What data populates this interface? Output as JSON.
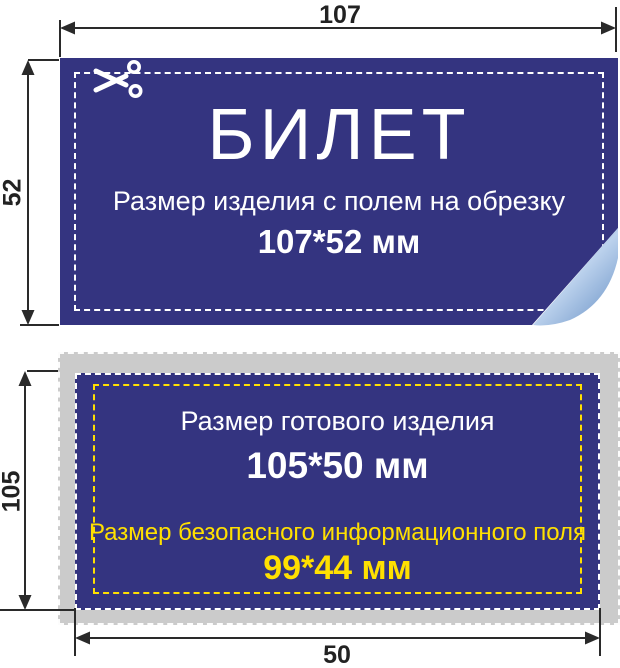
{
  "colors": {
    "card_blue": "#343480",
    "bleed_gray": "#cbcbcb",
    "safe_yellow": "#ffe000",
    "dimension_line": "#2a2a2a",
    "curl_dark": "#4a72b0",
    "curl_light": "#bcd2ed",
    "text_white": "#ffffff"
  },
  "icons": {
    "scissors": "scissors-icon"
  },
  "dimensions": {
    "top_width": "107",
    "bleed_height": "52",
    "trim_height": "105",
    "bottom_width": "50"
  },
  "bleed_card": {
    "title": "БИЛЕТ",
    "subtitle": "Размер изделия с полем на обрезку",
    "size": "107*52 мм"
  },
  "trim_card": {
    "finished_label": "Размер готового изделия",
    "finished_size": "105*50 мм",
    "safe_label": "Размер безопасного информационного поля",
    "safe_size": "99*44 мм"
  }
}
